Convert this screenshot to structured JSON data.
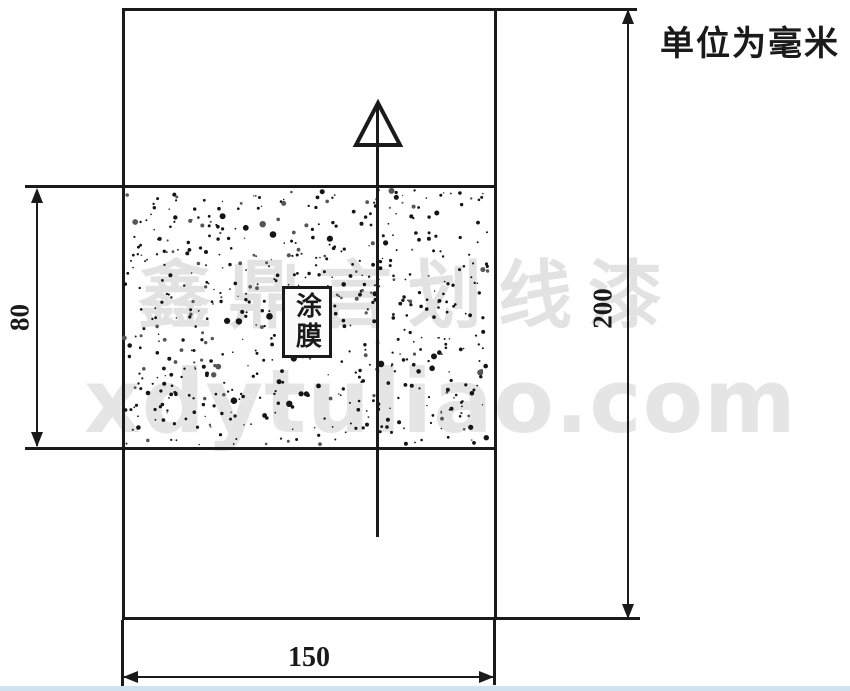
{
  "note": {
    "unit_label": "单位为毫米"
  },
  "drawing": {
    "title_hint": "coated test panel dimension drawing",
    "coating_label": "涂膜",
    "dimensions": {
      "panel_width": "150",
      "panel_height": "200",
      "coating_band_height": "80"
    }
  },
  "watermark": {
    "line1": "鑫鼎言划线漆",
    "line2": "xdytuliao.com"
  },
  "colors": {
    "line": "#1a1a1a",
    "watermark": "#e2e2e2",
    "bottom_strip": "#cfe2f0"
  }
}
